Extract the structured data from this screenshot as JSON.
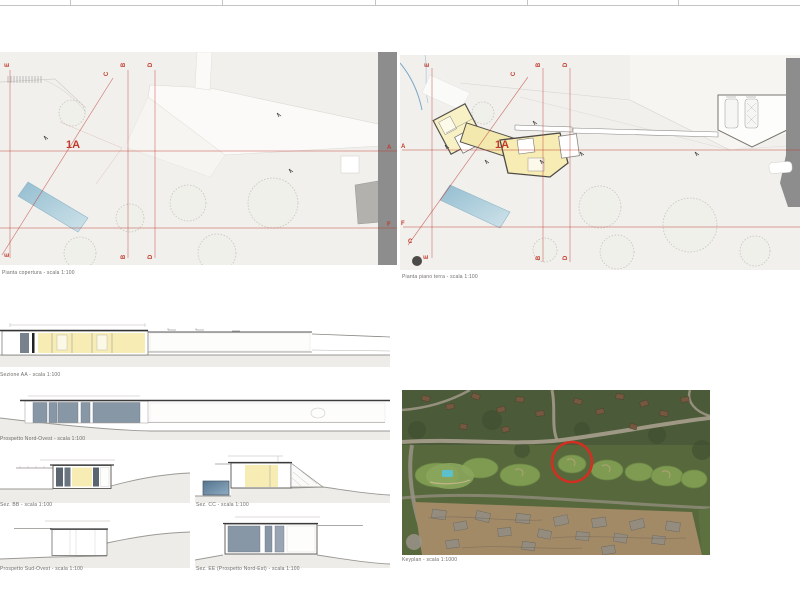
{
  "letters": {
    "a": "A",
    "b": "B",
    "c": "C",
    "d": "D",
    "e": "E",
    "f": "F"
  },
  "plans": {
    "roof": {
      "label": "1A",
      "caption": "Pianta copertura - scala 1:100"
    },
    "ground": {
      "label": "1A",
      "caption": "Pianta piano terra - scala 1:100"
    }
  },
  "sections": {
    "long": {
      "caption": "Sezione AA - scala 1:100"
    },
    "nw": {
      "caption": "Prospetto Nord-Ovest - scala 1:100"
    },
    "bb": {
      "caption": "Sez. BB - scala 1:100"
    },
    "cc": {
      "caption": "Sez. CC - scala 1:100"
    },
    "sw": {
      "caption": "Prospetto Sud-Ovest - scala 1:100"
    },
    "ee": {
      "caption": "Sez. EE (Prospetto Nord-Est) - scala 1:100"
    }
  },
  "aerial": {
    "caption": "Keyplan - scala 1:1000"
  },
  "colors": {
    "accent_red": "#c0392b",
    "room_yellow": "#f6ecb4",
    "pool_blue": "#9fc6d6",
    "road_gray": "#8d8d8d",
    "window_slate": "#8897a6",
    "marker_circle_red": "#d12f21"
  }
}
